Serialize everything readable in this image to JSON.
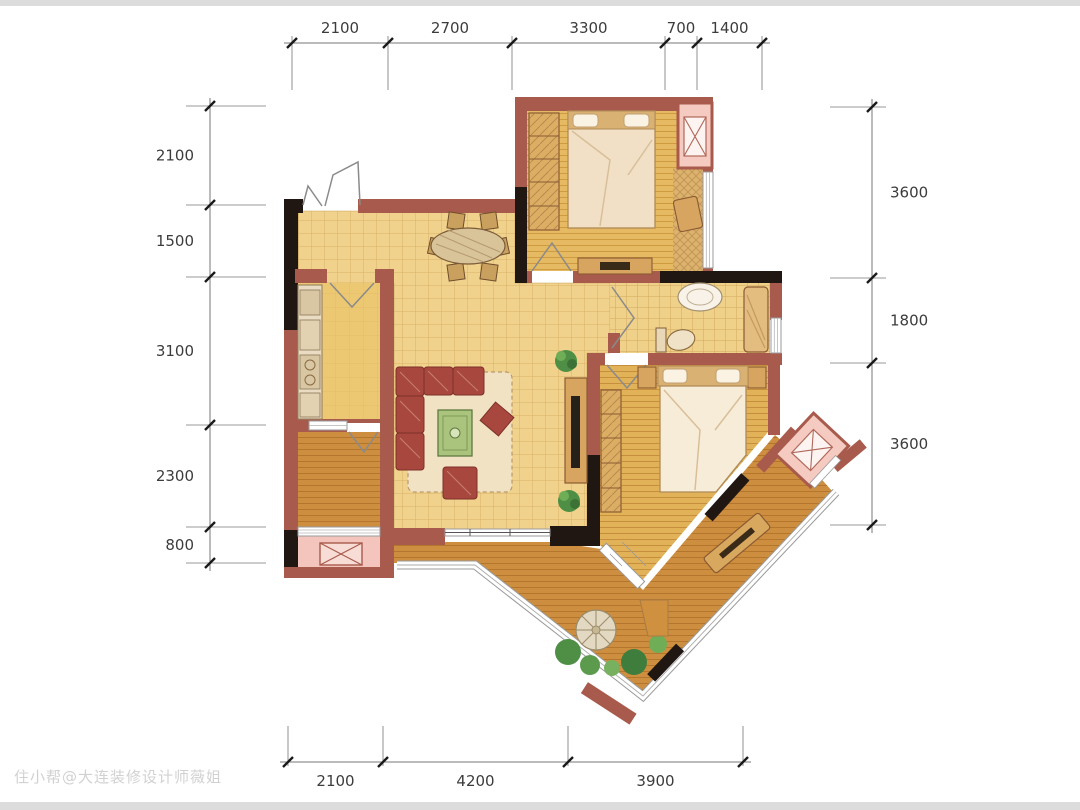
{
  "watermark": "住小帮@大连装修设计师薇姐",
  "dimensions": {
    "top": {
      "orientation": "h",
      "line": 43,
      "label_offset": -10,
      "ext": [
        36,
        90
      ],
      "ticks": [
        292,
        388,
        512,
        665,
        697,
        762
      ],
      "labels": [
        "2100",
        "2700",
        "3300",
        "700",
        "1400"
      ]
    },
    "bottom": {
      "orientation": "h",
      "line": 762,
      "label_offset": 24,
      "ext": [
        726,
        766
      ],
      "ticks": [
        288,
        383,
        568,
        743
      ],
      "labels": [
        "2100",
        "4200",
        "3900"
      ]
    },
    "left": {
      "orientation": "v",
      "line": 210,
      "label_offset": -16,
      "ext": [
        186,
        266
      ],
      "ticks": [
        106,
        205,
        277,
        425,
        527,
        563
      ],
      "labels": [
        "2100",
        "1500",
        "3100",
        "2300",
        "800"
      ]
    },
    "right": {
      "orientation": "v",
      "line": 872,
      "label_offset": 18,
      "ext": [
        830,
        886
      ],
      "ticks": [
        107,
        278,
        363,
        525
      ],
      "labels": [
        "3600",
        "1800",
        "3600"
      ]
    }
  },
  "colors": {
    "wall_red": "#a85b4c",
    "wall_black": "#211712",
    "tile": "#f1d28c",
    "tile_line": "#d9b168",
    "wood_bedroom": "#e6ba62",
    "wood_dark": "#cd8f3f",
    "balcony_pink": "#f3c5bc",
    "sofa_red": "#a8473e",
    "table_green": "#abc47d",
    "plant_green": "#4e8f45",
    "glass": "#ffffff"
  }
}
